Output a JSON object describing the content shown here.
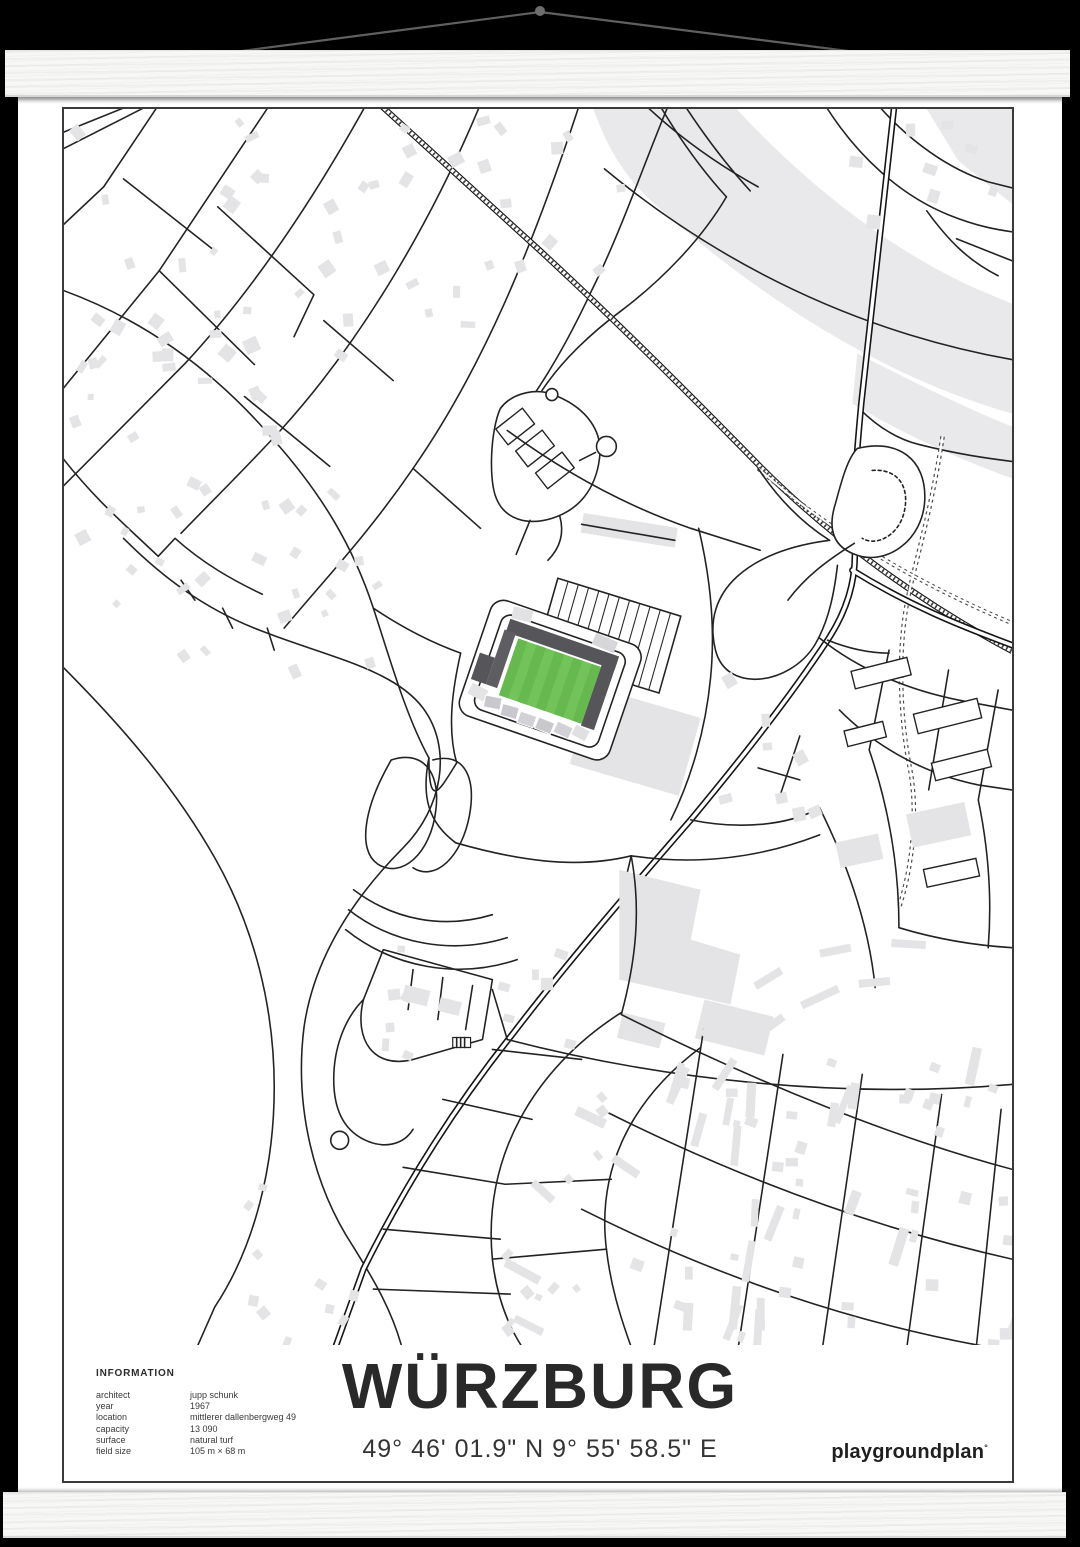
{
  "background_color": "#000000",
  "hanger": {
    "wood_color": "#f7f7f5",
    "string_color": "#606060",
    "knob_color": "#6e6e6e"
  },
  "poster": {
    "title": "WÜRZBURG",
    "coordinates": "49° 46' 01.9\" N 9° 55' 58.5\" E",
    "brand": "playgroundplan",
    "brand_mark": "°",
    "info": {
      "heading": "INFORMATION",
      "rows": [
        {
          "label": "architect",
          "value": "jupp schunk"
        },
        {
          "label": "year",
          "value": "1967"
        },
        {
          "label": "location",
          "value": "mittlerer dallenbergweg 49"
        },
        {
          "label": "capacity",
          "value": "13 090"
        },
        {
          "label": "surface",
          "value": "natural turf"
        },
        {
          "label": "field size",
          "value": "105 m × 68 m"
        }
      ]
    }
  },
  "map": {
    "road_color": "#232323",
    "building_color": "#e4e4e6",
    "river_color": "#e9e9eb",
    "frame_color": "#3a3a3a",
    "pitch_green": "#72c35a",
    "pitch_stripe_green": "#66b94e",
    "stand_dark": "#55555a",
    "stand_light": "#c9c9cd",
    "stand_pale": "#e3e3e5"
  }
}
